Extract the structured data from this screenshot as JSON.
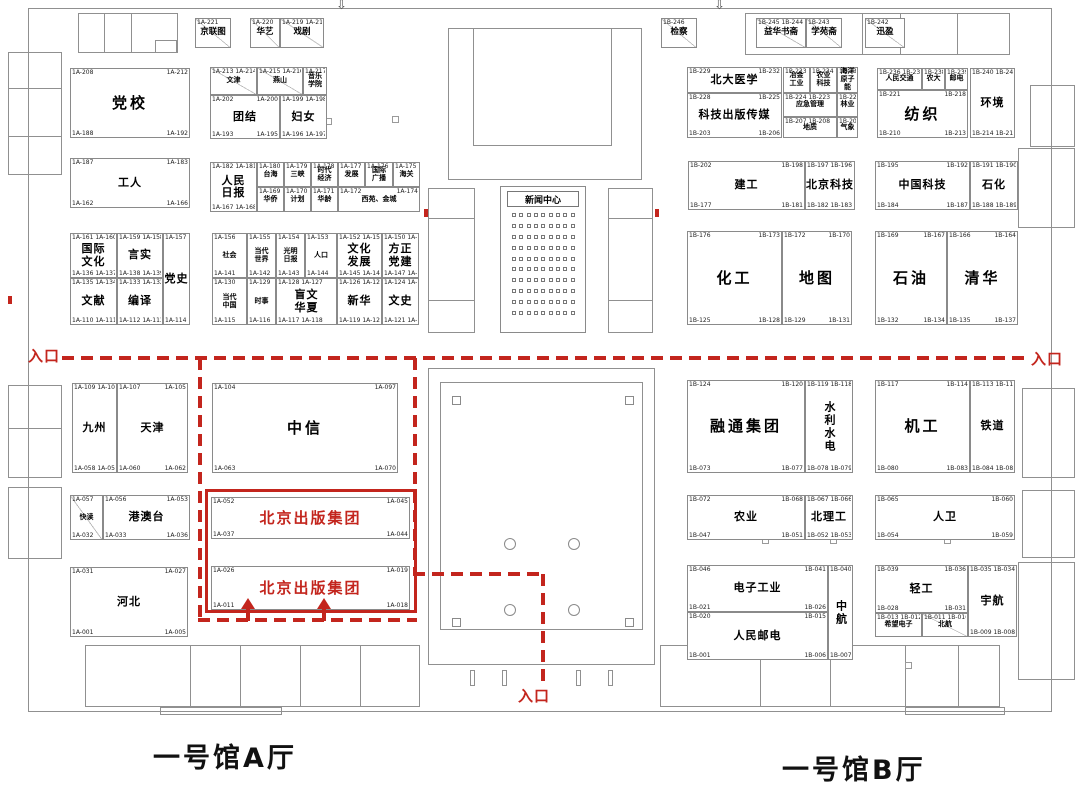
{
  "labels": {
    "hall_a": "一号馆A厅",
    "hall_b": "一号馆B厅",
    "entrance": "入口",
    "news_center": "新闻中心",
    "highlight_name": "北京出版集团"
  },
  "colors": {
    "highlight_red": "#c3251d",
    "wall_gray": "#8a8a8a"
  },
  "icons": {
    "down_arrow": "⇩"
  },
  "booths": [
    {
      "id": "jinglian",
      "x": 195,
      "y": 18,
      "w": 36,
      "h": 30,
      "cls": "sm diag",
      "tl": "1A-221",
      "label": "京联图"
    },
    {
      "id": "huayi",
      "x": 250,
      "y": 18,
      "w": 30,
      "h": 30,
      "cls": "sm diag",
      "tl": "1A-220",
      "label": "华艺"
    },
    {
      "id": "xiju",
      "x": 280,
      "y": 18,
      "w": 44,
      "h": 30,
      "cls": "sm diag",
      "tl": "1A-219 1A-218",
      "label": "戏剧"
    },
    {
      "id": "dangxiao",
      "x": 70,
      "y": 68,
      "w": 120,
      "h": 70,
      "cls": "lg",
      "tl": "1A-208",
      "tr": "1A-212",
      "bl": "1A-188",
      "br": "1A-192",
      "label": "党校"
    },
    {
      "id": "wenjin",
      "x": 210,
      "y": 67,
      "w": 47,
      "h": 28,
      "cls": "xs diag",
      "tl": "1A-213 1A-214",
      "label": "文津"
    },
    {
      "id": "yanshan",
      "x": 257,
      "y": 67,
      "w": 46,
      "h": 28,
      "cls": "xs diag",
      "tl": "1A-215 1A-216",
      "label": "燕山"
    },
    {
      "id": "yinyue-xueyuan",
      "x": 303,
      "y": 67,
      "w": 24,
      "h": 28,
      "cls": "xs",
      "tl": "1A-217",
      "label": "音乐\n学院"
    },
    {
      "id": "tuanjie",
      "x": 210,
      "y": 95,
      "w": 70,
      "h": 44,
      "cls": "md",
      "tl": "1A-202",
      "tr": "1A-200",
      "bl": "1A-193",
      "br": "1A-195",
      "label": "团结"
    },
    {
      "id": "funv",
      "x": 280,
      "y": 95,
      "w": 47,
      "h": 44,
      "cls": "md",
      "tl": "1A-199 1A-198",
      "bl": "1A-196 1A-197",
      "label": "妇女"
    },
    {
      "id": "gongren",
      "x": 70,
      "y": 158,
      "w": 120,
      "h": 50,
      "cls": "md",
      "tl": "1A-187",
      "tr": "1A-183",
      "bl": "1A-162",
      "br": "1A-166",
      "label": "工人"
    },
    {
      "id": "renmin-ribao",
      "x": 210,
      "y": 162,
      "w": 47,
      "h": 50,
      "cls": "md",
      "tl": "1A-182 1A-181",
      "bl": "1A-167 1A-168",
      "label": "人民\n日报"
    },
    {
      "id": "taihai",
      "x": 257,
      "y": 162,
      "w": 27,
      "h": 25,
      "cls": "xs",
      "tl": "1A-180",
      "label": "台海"
    },
    {
      "id": "sanxia",
      "x": 284,
      "y": 162,
      "w": 27,
      "h": 25,
      "cls": "xs",
      "tl": "1A-179",
      "label": "三峡"
    },
    {
      "id": "shidai-jingji",
      "x": 311,
      "y": 162,
      "w": 27,
      "h": 25,
      "cls": "xs",
      "tl": "1A-178",
      "label": "时代\n经济"
    },
    {
      "id": "fazhan",
      "x": 338,
      "y": 162,
      "w": 27,
      "h": 25,
      "cls": "xs",
      "tl": "1A-177",
      "label": "发展"
    },
    {
      "id": "guoji-guangbo",
      "x": 365,
      "y": 162,
      "w": 28,
      "h": 25,
      "cls": "xs",
      "tl": "1A-176",
      "label": "国际\n广播"
    },
    {
      "id": "haiguan",
      "x": 393,
      "y": 162,
      "w": 27,
      "h": 25,
      "cls": "xs",
      "tl": "1A-175",
      "label": "海关"
    },
    {
      "id": "huaqiao",
      "x": 257,
      "y": 187,
      "w": 27,
      "h": 25,
      "cls": "xs",
      "tl": "1A-169",
      "label": "华侨"
    },
    {
      "id": "jihua",
      "x": 284,
      "y": 187,
      "w": 27,
      "h": 25,
      "cls": "xs",
      "tl": "1A-170",
      "label": "计划"
    },
    {
      "id": "hualing",
      "x": 311,
      "y": 187,
      "w": 27,
      "h": 25,
      "cls": "xs",
      "tl": "1A-171",
      "label": "华龄"
    },
    {
      "id": "xiyuan-jincheng",
      "x": 338,
      "y": 187,
      "w": 82,
      "h": 25,
      "cls": "xs",
      "tl": "1A-172",
      "tr": "1A-174",
      "label": "西苑、金城"
    },
    {
      "id": "guoji-wenhua",
      "x": 70,
      "y": 233,
      "w": 47,
      "h": 45,
      "cls": "md",
      "tl": "1A-161 1A-160",
      "bl": "1A-136 1A-137",
      "label": "国际\n文化"
    },
    {
      "id": "yanshi",
      "x": 117,
      "y": 233,
      "w": 46,
      "h": 45,
      "cls": "md",
      "tl": "1A-159 1A-158",
      "bl": "1A-138 1A-139",
      "label": "言实"
    },
    {
      "id": "dangshi",
      "x": 163,
      "y": 233,
      "w": 27,
      "h": 92,
      "cls": "md",
      "tl": "1A-157",
      "bl": "1A-114",
      "label": "党史"
    },
    {
      "id": "wenxian",
      "x": 70,
      "y": 278,
      "w": 47,
      "h": 47,
      "cls": "md",
      "tl": "1A-135 1A-134",
      "bl": "1A-110 1A-111",
      "label": "文献"
    },
    {
      "id": "bianyi",
      "x": 117,
      "y": 278,
      "w": 46,
      "h": 47,
      "cls": "md",
      "tl": "1A-133 1A-132",
      "bl": "1A-112 1A-113",
      "label": "编译"
    },
    {
      "id": "shehui",
      "x": 212,
      "y": 233,
      "w": 35,
      "h": 45,
      "cls": "xs",
      "tl": "1A-156",
      "bl": "1A-141",
      "label": "社会"
    },
    {
      "id": "dangdai-shijie",
      "x": 247,
      "y": 233,
      "w": 29,
      "h": 45,
      "cls": "xs",
      "tl": "1A-155",
      "bl": "1A-142",
      "label": "当代\n世界"
    },
    {
      "id": "guangming-ribao",
      "x": 276,
      "y": 233,
      "w": 29,
      "h": 45,
      "cls": "xs",
      "tl": "1A-154",
      "bl": "1A-143",
      "label": "光明\n日报"
    },
    {
      "id": "renkou",
      "x": 305,
      "y": 233,
      "w": 32,
      "h": 45,
      "cls": "xs",
      "tl": "1A-153",
      "bl": "1A-144",
      "label": "人口"
    },
    {
      "id": "dangdai-zhongguo",
      "x": 212,
      "y": 278,
      "w": 35,
      "h": 47,
      "cls": "xs",
      "tl": "1A-130",
      "bl": "1A-115",
      "label": "当代\n中国"
    },
    {
      "id": "shishi",
      "x": 247,
      "y": 278,
      "w": 29,
      "h": 47,
      "cls": "xs",
      "tl": "1A-129",
      "bl": "1A-116",
      "label": "时事"
    },
    {
      "id": "mangwen-huaxia",
      "x": 276,
      "y": 278,
      "w": 61,
      "h": 47,
      "cls": "md",
      "tl": "1A-128 1A-127",
      "bl": "1A-117 1A-118",
      "label": "盲文\n华夏"
    },
    {
      "id": "wenhua-fazhan",
      "x": 337,
      "y": 233,
      "w": 45,
      "h": 45,
      "cls": "md",
      "tl": "1A-152 1A-151",
      "bl": "1A-145 1A-146",
      "label": "文化\n发展"
    },
    {
      "id": "fangzheng-dangjian",
      "x": 382,
      "y": 233,
      "w": 37,
      "h": 45,
      "cls": "md",
      "tl": "1A-150 1A-149",
      "bl": "1A-147 1A-148",
      "label": "方正\n党建"
    },
    {
      "id": "xinhua",
      "x": 337,
      "y": 278,
      "w": 45,
      "h": 47,
      "cls": "md",
      "tl": "1A-126 1A-125",
      "bl": "1A-119 1A-120",
      "label": "新华"
    },
    {
      "id": "wenshi",
      "x": 382,
      "y": 278,
      "w": 37,
      "h": 47,
      "cls": "md",
      "tl": "1A-124 1A-123",
      "bl": "1A-121 1A-122",
      "label": "文史"
    },
    {
      "id": "jiuzhou",
      "x": 72,
      "y": 383,
      "w": 45,
      "h": 90,
      "cls": "md",
      "tl": "1A-109 1A-108",
      "bl": "1A-058 1A-059",
      "label": "九州"
    },
    {
      "id": "tianjin",
      "x": 117,
      "y": 383,
      "w": 71,
      "h": 90,
      "cls": "md",
      "tl": "1A-107",
      "tr": "1A-105",
      "bl": "1A-060",
      "br": "1A-062",
      "label": "天津"
    },
    {
      "id": "zhongxin",
      "x": 212,
      "y": 383,
      "w": 186,
      "h": 90,
      "cls": "lg",
      "tl": "1A-104",
      "tr": "1A-097",
      "bl": "1A-063",
      "br": "1A-070",
      "label": "中信"
    },
    {
      "id": "kuaidu",
      "x": 70,
      "y": 495,
      "w": 33,
      "h": 45,
      "cls": "xs diag",
      "tl": "1A-057",
      "bl": "1A-032",
      "label": "快读"
    },
    {
      "id": "gangaotai",
      "x": 103,
      "y": 495,
      "w": 87,
      "h": 45,
      "cls": "md",
      "tl": "1A-056",
      "tr": "1A-053",
      "bl": "1A-033",
      "br": "1A-036",
      "label": "港澳台"
    },
    {
      "id": "hebei",
      "x": 70,
      "y": 567,
      "w": 118,
      "h": 70,
      "cls": "md",
      "tl": "1A-031",
      "tr": "1A-027",
      "bl": "1A-001",
      "br": "1A-005",
      "label": "河北"
    },
    {
      "id": "beijing-chuban-jituan-1",
      "x": 211,
      "y": 497,
      "w": 199,
      "h": 42,
      "cls": "red",
      "tl": "1A-052",
      "tr": "1A-045",
      "bl": "1A-037",
      "br": "1A-044",
      "label": "北京出版集团"
    },
    {
      "id": "beijing-chuban-jituan-2",
      "x": 211,
      "y": 566,
      "w": 199,
      "h": 44,
      "cls": "red",
      "tl": "1A-026",
      "tr": "1A-019",
      "bl": "1A-011",
      "br": "1A-018",
      "label": "北京出版集团"
    },
    {
      "id": "jiancha",
      "x": 661,
      "y": 18,
      "w": 36,
      "h": 30,
      "cls": "sm diag",
      "tl": "1B-246",
      "label": "检察"
    },
    {
      "id": "yihua-shuzhai",
      "x": 756,
      "y": 18,
      "w": 50,
      "h": 30,
      "cls": "sm diag",
      "tl": "1B-245 1B-244",
      "label": "益华书斋"
    },
    {
      "id": "xueyuanzhai",
      "x": 806,
      "y": 18,
      "w": 36,
      "h": 30,
      "cls": "sm diag",
      "tl": "1B-243",
      "label": "学苑斋"
    },
    {
      "id": "xunying",
      "x": 865,
      "y": 18,
      "w": 40,
      "h": 30,
      "cls": "sm diag",
      "tl": "1B-242",
      "label": "迅盈"
    },
    {
      "id": "beida-yixue",
      "x": 687,
      "y": 67,
      "w": 95,
      "h": 26,
      "cls": "md",
      "tl": "1B-229",
      "tr": "1B-232",
      "label": "北大医学"
    },
    {
      "id": "keji-chuban-chuanmei",
      "x": 687,
      "y": 93,
      "w": 95,
      "h": 45,
      "cls": "md",
      "tl": "1B-228",
      "tr": "1B-225",
      "bl": "1B-203",
      "br": "1B-206",
      "label": "科技出版传媒"
    },
    {
      "id": "yejin-gongye",
      "x": 783,
      "y": 67,
      "w": 27,
      "h": 26,
      "cls": "xs",
      "tl": "1B-233",
      "label": "冶金\n工业"
    },
    {
      "id": "nongye-keji",
      "x": 810,
      "y": 67,
      "w": 27,
      "h": 26,
      "cls": "xs",
      "tl": "1B-234",
      "label": "农业\n科技"
    },
    {
      "id": "haiyang-yuanzineng",
      "x": 837,
      "y": 67,
      "w": 21,
      "h": 26,
      "cls": "xs",
      "tl": "1B-235",
      "label": "海洋\n原子能"
    },
    {
      "id": "yingji-guanli",
      "x": 783,
      "y": 93,
      "w": 54,
      "h": 24,
      "cls": "xs",
      "tl": "1B-224 1B-223",
      "label": "应急管理"
    },
    {
      "id": "linye",
      "x": 837,
      "y": 93,
      "w": 21,
      "h": 24,
      "cls": "xs",
      "tl": "1B-222",
      "label": "林业"
    },
    {
      "id": "dizhi",
      "x": 783,
      "y": 117,
      "w": 54,
      "h": 21,
      "cls": "xs",
      "tl": "1B-207 1B-208",
      "label": "地质"
    },
    {
      "id": "qixiang",
      "x": 837,
      "y": 117,
      "w": 21,
      "h": 21,
      "cls": "xs",
      "tl": "1B-209",
      "label": "气象"
    },
    {
      "id": "renmin-jiaotong",
      "x": 877,
      "y": 68,
      "w": 45,
      "h": 22,
      "cls": "xs",
      "tl": "1B-236 1B-237",
      "label": "人民交通"
    },
    {
      "id": "nongda",
      "x": 922,
      "y": 68,
      "w": 23,
      "h": 22,
      "cls": "xs",
      "tl": "1B-238",
      "label": "农大"
    },
    {
      "id": "youdian",
      "x": 945,
      "y": 68,
      "w": 23,
      "h": 22,
      "cls": "xs",
      "tl": "1B-239",
      "label": "邮电"
    },
    {
      "id": "fangzhi",
      "x": 877,
      "y": 90,
      "w": 91,
      "h": 48,
      "cls": "lg",
      "tl": "1B-221",
      "tr": "1B-218",
      "bl": "1B-210",
      "br": "1B-213",
      "label": "纺织"
    },
    {
      "id": "huanjing",
      "x": 970,
      "y": 68,
      "w": 45,
      "h": 70,
      "cls": "md",
      "tl": "1B-240 1B-241",
      "bl": "1B-214 1B-215",
      "label": "环境"
    },
    {
      "id": "jiangong",
      "x": 688,
      "y": 161,
      "w": 117,
      "h": 49,
      "cls": "md",
      "tl": "1B-202",
      "tr": "1B-198",
      "bl": "1B-177",
      "br": "1B-181",
      "label": "建工"
    },
    {
      "id": "beijing-keji",
      "x": 805,
      "y": 161,
      "w": 50,
      "h": 49,
      "cls": "md",
      "tl": "1B-197 1B-196",
      "bl": "1B-182 1B-183",
      "label": "北京科技"
    },
    {
      "id": "zhongguo-keji",
      "x": 875,
      "y": 161,
      "w": 95,
      "h": 49,
      "cls": "md",
      "tl": "1B-195",
      "tr": "1B-192",
      "bl": "1B-184",
      "br": "1B-187",
      "label": "中国科技"
    },
    {
      "id": "shihua",
      "x": 970,
      "y": 161,
      "w": 48,
      "h": 49,
      "cls": "md",
      "tl": "1B-191 1B-190",
      "bl": "1B-188 1B-189",
      "label": "石化"
    },
    {
      "id": "huagong",
      "x": 687,
      "y": 231,
      "w": 95,
      "h": 94,
      "cls": "lg",
      "tl": "1B-176",
      "tr": "1B-173",
      "bl": "1B-125",
      "br": "1B-128",
      "label": "化工"
    },
    {
      "id": "ditu",
      "x": 782,
      "y": 231,
      "w": 70,
      "h": 94,
      "cls": "lg",
      "tl": "1B-172",
      "tr": "1B-170",
      "bl": "1B-129",
      "br": "1B-131",
      "label": "地图"
    },
    {
      "id": "shiyou",
      "x": 875,
      "y": 231,
      "w": 72,
      "h": 94,
      "cls": "lg",
      "tl": "1B-169",
      "tr": "1B-167",
      "bl": "1B-132",
      "br": "1B-134",
      "label": "石油"
    },
    {
      "id": "qinghua",
      "x": 947,
      "y": 231,
      "w": 71,
      "h": 94,
      "cls": "lg",
      "tl": "1B-166",
      "tr": "1B-164",
      "bl": "1B-135",
      "br": "1B-137",
      "label": "清华"
    },
    {
      "id": "rongtong-jituan",
      "x": 687,
      "y": 380,
      "w": 118,
      "h": 93,
      "cls": "lg",
      "tl": "1B-124",
      "tr": "1B-120",
      "bl": "1B-073",
      "br": "1B-077",
      "label": "融通集团"
    },
    {
      "id": "shuili-shuidian",
      "x": 805,
      "y": 380,
      "w": 48,
      "h": 93,
      "cls": "md vert",
      "tl": "1B-119 1B-118",
      "bl": "1B-078 1B-079",
      "label": "水利水电"
    },
    {
      "id": "jigong",
      "x": 875,
      "y": 380,
      "w": 95,
      "h": 93,
      "cls": "lg",
      "tl": "1B-117",
      "tr": "1B-114",
      "bl": "1B-080",
      "br": "1B-083",
      "label": "机工"
    },
    {
      "id": "tiedao",
      "x": 970,
      "y": 380,
      "w": 45,
      "h": 93,
      "cls": "md",
      "tl": "1B-113 1B-112",
      "bl": "1B-084 1B-085",
      "label": "铁道"
    },
    {
      "id": "nongye",
      "x": 687,
      "y": 495,
      "w": 118,
      "h": 45,
      "cls": "md",
      "tl": "1B-072",
      "tr": "1B-068",
      "bl": "1B-047",
      "br": "1B-051",
      "label": "农业"
    },
    {
      "id": "beiligong",
      "x": 805,
      "y": 495,
      "w": 48,
      "h": 45,
      "cls": "md",
      "tl": "1B-067 1B-066",
      "bl": "1B-052 1B-053",
      "label": "北理工"
    },
    {
      "id": "renwei",
      "x": 875,
      "y": 495,
      "w": 140,
      "h": 45,
      "cls": "md",
      "tl": "1B-065",
      "tr": "1B-060",
      "bl": "1B-054",
      "br": "1B-059",
      "label": "人卫"
    },
    {
      "id": "dianzi-gongye",
      "x": 687,
      "y": 565,
      "w": 141,
      "h": 47,
      "cls": "md",
      "tl": "1B-046",
      "tr": "1B-041",
      "bl": "1B-021",
      "br": "1B-026",
      "label": "电子工业"
    },
    {
      "id": "renmin-youdian",
      "x": 687,
      "y": 612,
      "w": 141,
      "h": 48,
      "cls": "md",
      "tl": "1B-020",
      "tr": "1B-015",
      "bl": "1B-001",
      "br": "1B-006",
      "label": "人民邮电"
    },
    {
      "id": "zhonghang",
      "x": 828,
      "y": 565,
      "w": 25,
      "h": 95,
      "cls": "md vert",
      "tl": "1B-040",
      "bl": "1B-007",
      "label": "中航"
    },
    {
      "id": "qinggong",
      "x": 875,
      "y": 565,
      "w": 93,
      "h": 48,
      "cls": "md",
      "tl": "1B-039",
      "tr": "1B-036",
      "bl": "1B-028",
      "br": "1B-031",
      "label": "轻工"
    },
    {
      "id": "xiwang-dianzi",
      "x": 875,
      "y": 613,
      "w": 47,
      "h": 24,
      "cls": "xs",
      "tl": "1B-013 1B-012",
      "label": "希望电子"
    },
    {
      "id": "beihang",
      "x": 922,
      "y": 613,
      "w": 46,
      "h": 24,
      "cls": "xs diag",
      "tl": "1B-011 1B-010",
      "label": "北航"
    },
    {
      "id": "yuhang",
      "x": 968,
      "y": 565,
      "w": 49,
      "h": 72,
      "cls": "md",
      "tl": "1B-035 1B-034",
      "bl": "1B-009 1B-008",
      "label": "宇航"
    }
  ]
}
